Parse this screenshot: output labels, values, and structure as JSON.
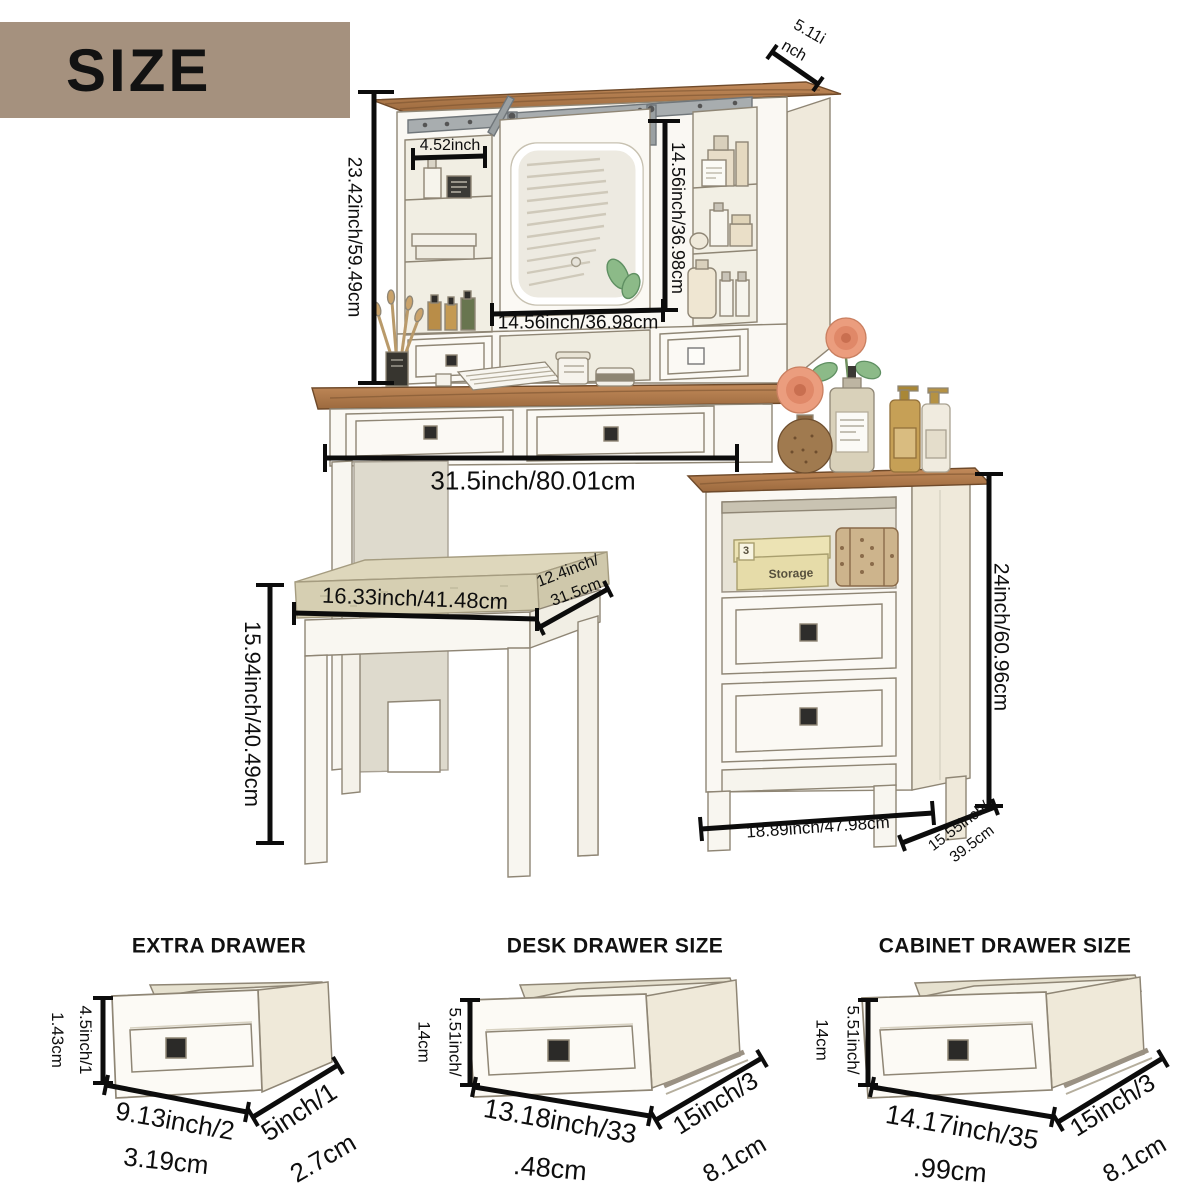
{
  "banner": {
    "title": "SIZE"
  },
  "main_diagram": {
    "hutch": {
      "height": "23.42inch/59.49cm",
      "shelf_width": "4.52inch",
      "top_depth_line1": "5.11i",
      "top_depth_line2": "nch",
      "mirror_height": "14.56inch/36.98cm",
      "mirror_width": "14.56inch/36.98cm"
    },
    "desk": {
      "width": "31.5inch/80.01cm"
    },
    "stool": {
      "height": "15.94inch/40.49cm",
      "width": "16.33inch/41.48cm",
      "depth_line1": "12.4inch/",
      "depth_line2": "31.5cm"
    },
    "cabinet": {
      "height": "24inch/60.96cm",
      "width": "18.89inch/47.98cm",
      "depth_line1": "15.55inch/",
      "depth_line2": "39.5cm"
    },
    "decor": {
      "storage_box_label": "Storage",
      "storage_box_number": "3"
    }
  },
  "sections": {
    "extra_drawer": {
      "title": "EXTRA DRAWER",
      "height_line1": "4.5inch/1",
      "height_line2": "1.43cm",
      "width_line1": "9.13inch/2",
      "width_line2": "3.19cm",
      "depth_line1": "5inch/1",
      "depth_line2": "2.7cm"
    },
    "desk_drawer": {
      "title": "DESK DRAWER SIZE",
      "height_line1": "5.51inch/",
      "height_line2": "14cm",
      "width_line1": "13.18inch/33",
      "width_line2": ".48cm",
      "depth_line1": "15inch/3",
      "depth_line2": "8.1cm"
    },
    "cabinet_drawer": {
      "title": "CABINET DRAWER SIZE",
      "height_line1": "5.51inch/",
      "height_line2": "14cm",
      "width_line1": "14.17inch/35",
      "width_line2": ".99cm",
      "depth_line1": "15inch/3",
      "depth_line2": "8.1cm"
    }
  },
  "colors": {
    "banner_bg": "#a5917e",
    "dimension_line": "#0c0c0c",
    "wood": "#b07c4e",
    "furniture_white": "#faf8f3",
    "cushion": "#ded7bc",
    "flower": "#e89a7c",
    "leaf": "#8cba88",
    "amber_bottle": "#c6a056"
  }
}
